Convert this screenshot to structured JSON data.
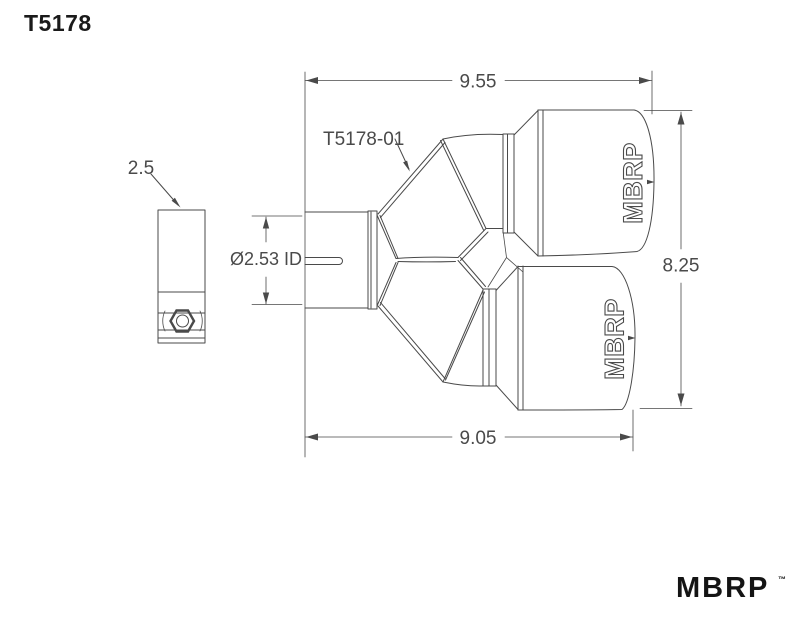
{
  "sheet": {
    "title": "T5178"
  },
  "side_view": {
    "dim_diameter": "2.5"
  },
  "main_view": {
    "part_label": "T5178-01",
    "dim_overall_top": "9.55",
    "dim_overall_bottom": "9.05",
    "dim_height": "8.25",
    "dim_inlet_id": "Ø2.53 ID",
    "tip_logo": "MBRP"
  },
  "footer": {
    "brand": "MBRP",
    "trademark": "™"
  },
  "colors": {
    "line": "#4a4a4a",
    "text": "#383838",
    "background": "#ffffff"
  }
}
